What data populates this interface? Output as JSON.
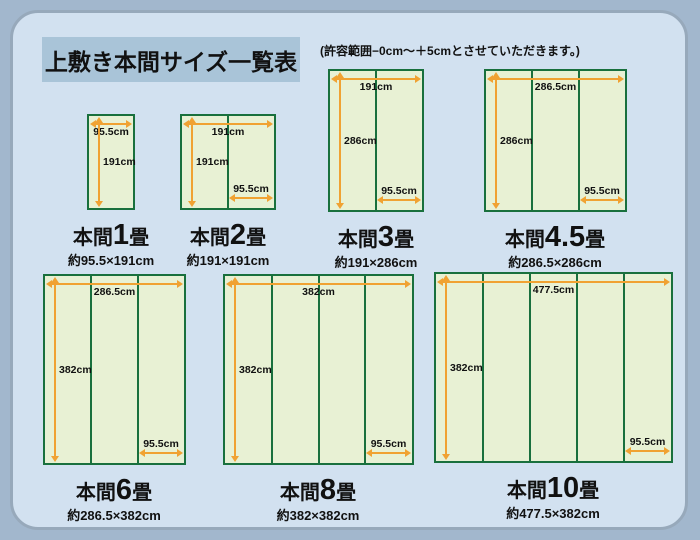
{
  "title": "上敷き本間サイズ一覧表",
  "note": "(許容範囲−0cm〜＋5cmとさせていただきます。)",
  "colors": {
    "background": "#a2b7cd",
    "panel": "#d2e1f0",
    "title_box": "#a9c4d8",
    "mat_fill": "#e8f1d4",
    "mat_border_green": "#19703d",
    "arrow_orange": "#f0a232"
  },
  "diagrams": [
    {
      "name_prefix": "本間",
      "name_number": "1",
      "name_suffix": "畳",
      "size_text": "約95.5×191cm",
      "width_cm": 95.5,
      "height_cm": 191,
      "columns": 1,
      "width_label": "95.5cm",
      "height_label": "191cm",
      "tail_label": ""
    },
    {
      "name_prefix": "本間",
      "name_number": "2",
      "name_suffix": "畳",
      "size_text": "約191×191cm",
      "width_cm": 191,
      "height_cm": 191,
      "columns": 2,
      "width_label": "191cm",
      "height_label": "191cm",
      "tail_label": "95.5cm"
    },
    {
      "name_prefix": "本間",
      "name_number": "3",
      "name_suffix": "畳",
      "size_text": "約191×286cm",
      "width_cm": 191,
      "height_cm": 286,
      "columns": 2,
      "width_label": "191cm",
      "height_label": "286cm",
      "tail_label": "95.5cm"
    },
    {
      "name_prefix": "本間",
      "name_number": "4.5",
      "name_suffix": "畳",
      "size_text": "約286.5×286cm",
      "width_cm": 286.5,
      "height_cm": 286,
      "columns": 3,
      "width_label": "286.5cm",
      "height_label": "286cm",
      "tail_label": "95.5cm"
    },
    {
      "name_prefix": "本間",
      "name_number": "6",
      "name_suffix": "畳",
      "size_text": "約286.5×382cm",
      "width_cm": 286.5,
      "height_cm": 382,
      "columns": 3,
      "width_label": "286.5cm",
      "height_label": "382cm",
      "tail_label": "95.5cm"
    },
    {
      "name_prefix": "本間",
      "name_number": "8",
      "name_suffix": "畳",
      "size_text": "約382×382cm",
      "width_cm": 382,
      "height_cm": 382,
      "columns": 4,
      "width_label": "382cm",
      "height_label": "382cm",
      "tail_label": "95.5cm"
    },
    {
      "name_prefix": "本間",
      "name_number": "10",
      "name_suffix": "畳",
      "size_text": "約477.5×382cm",
      "width_cm": 477.5,
      "height_cm": 382,
      "columns": 5,
      "width_label": "477.5cm",
      "height_label": "382cm",
      "tail_label": "95.5cm"
    }
  ]
}
